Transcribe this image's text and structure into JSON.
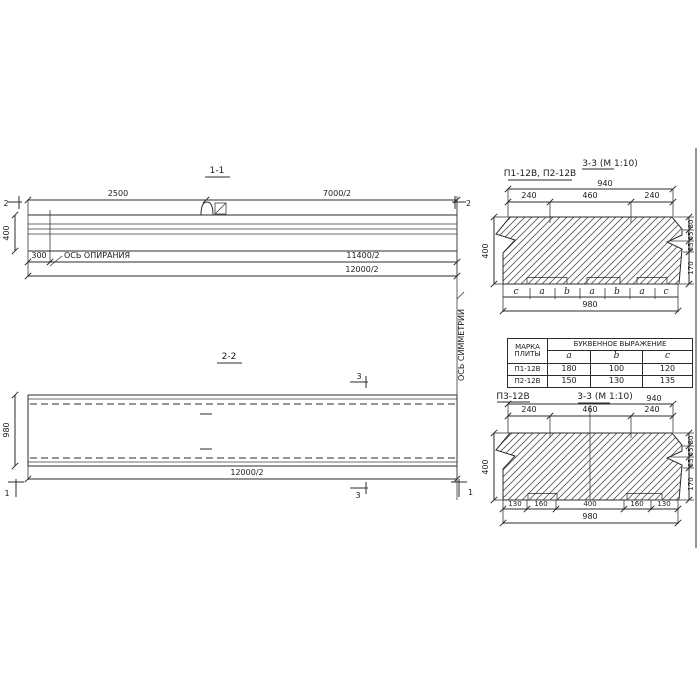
{
  "s11": {
    "title": "1-1",
    "cut_label": "2",
    "dim_2500": "2500",
    "dim_7000": "7000/2",
    "dim_400": "400",
    "dim_300": "300",
    "dim_11400": "11400/2",
    "dim_12000": "12000/2",
    "bearing_axis_label": "ОСЬ ОПИРАНИЯ"
  },
  "s22": {
    "title": "2-2",
    "cut3_label": "3",
    "cut1_label": "1",
    "dim_980": "980",
    "dim_12000": "12000/2"
  },
  "sym": {
    "label": "ОСЬ СИММЕТРИИ"
  },
  "s33top": {
    "marks_label": "П1-12В, П2-12В",
    "title": "3-3 (М 1:10)",
    "dim_940": "940",
    "dim_240l": "240",
    "dim_460": "460",
    "dim_240r": "240",
    "dim_400": "400",
    "r80": "80",
    "r65a": "65",
    "r65b": "65",
    "r170": "170",
    "letters": [
      "c",
      "a",
      "b",
      "a",
      "b",
      "a",
      "c"
    ],
    "dim_980": "980"
  },
  "table": {
    "col_mark_line1": "МАРКА",
    "col_mark_line2": "ПЛИТЫ",
    "col_expr": "БУКВЕННОЕ  ВЫРАЖЕНИЕ",
    "sub_headers": [
      "a",
      "b",
      "c"
    ],
    "rows": [
      {
        "mark": "П1-12В",
        "a": "180",
        "b": "100",
        "c": "120"
      },
      {
        "mark": "П2-12В",
        "a": "150",
        "b": "130",
        "c": "135"
      }
    ]
  },
  "s33bot": {
    "mark_label": "П3-12В",
    "title": "3-3 (М 1:10)",
    "dim_940": "940",
    "dim_240l": "240",
    "dim_460": "460",
    "dim_240r": "240",
    "dim_400": "400",
    "r80": "80",
    "r65a": "65",
    "r65b": "65",
    "r170": "170",
    "b130l": "130",
    "b160l": "160",
    "b400": "400",
    "b160r": "160",
    "b130r": "130",
    "dim_980": "980"
  }
}
